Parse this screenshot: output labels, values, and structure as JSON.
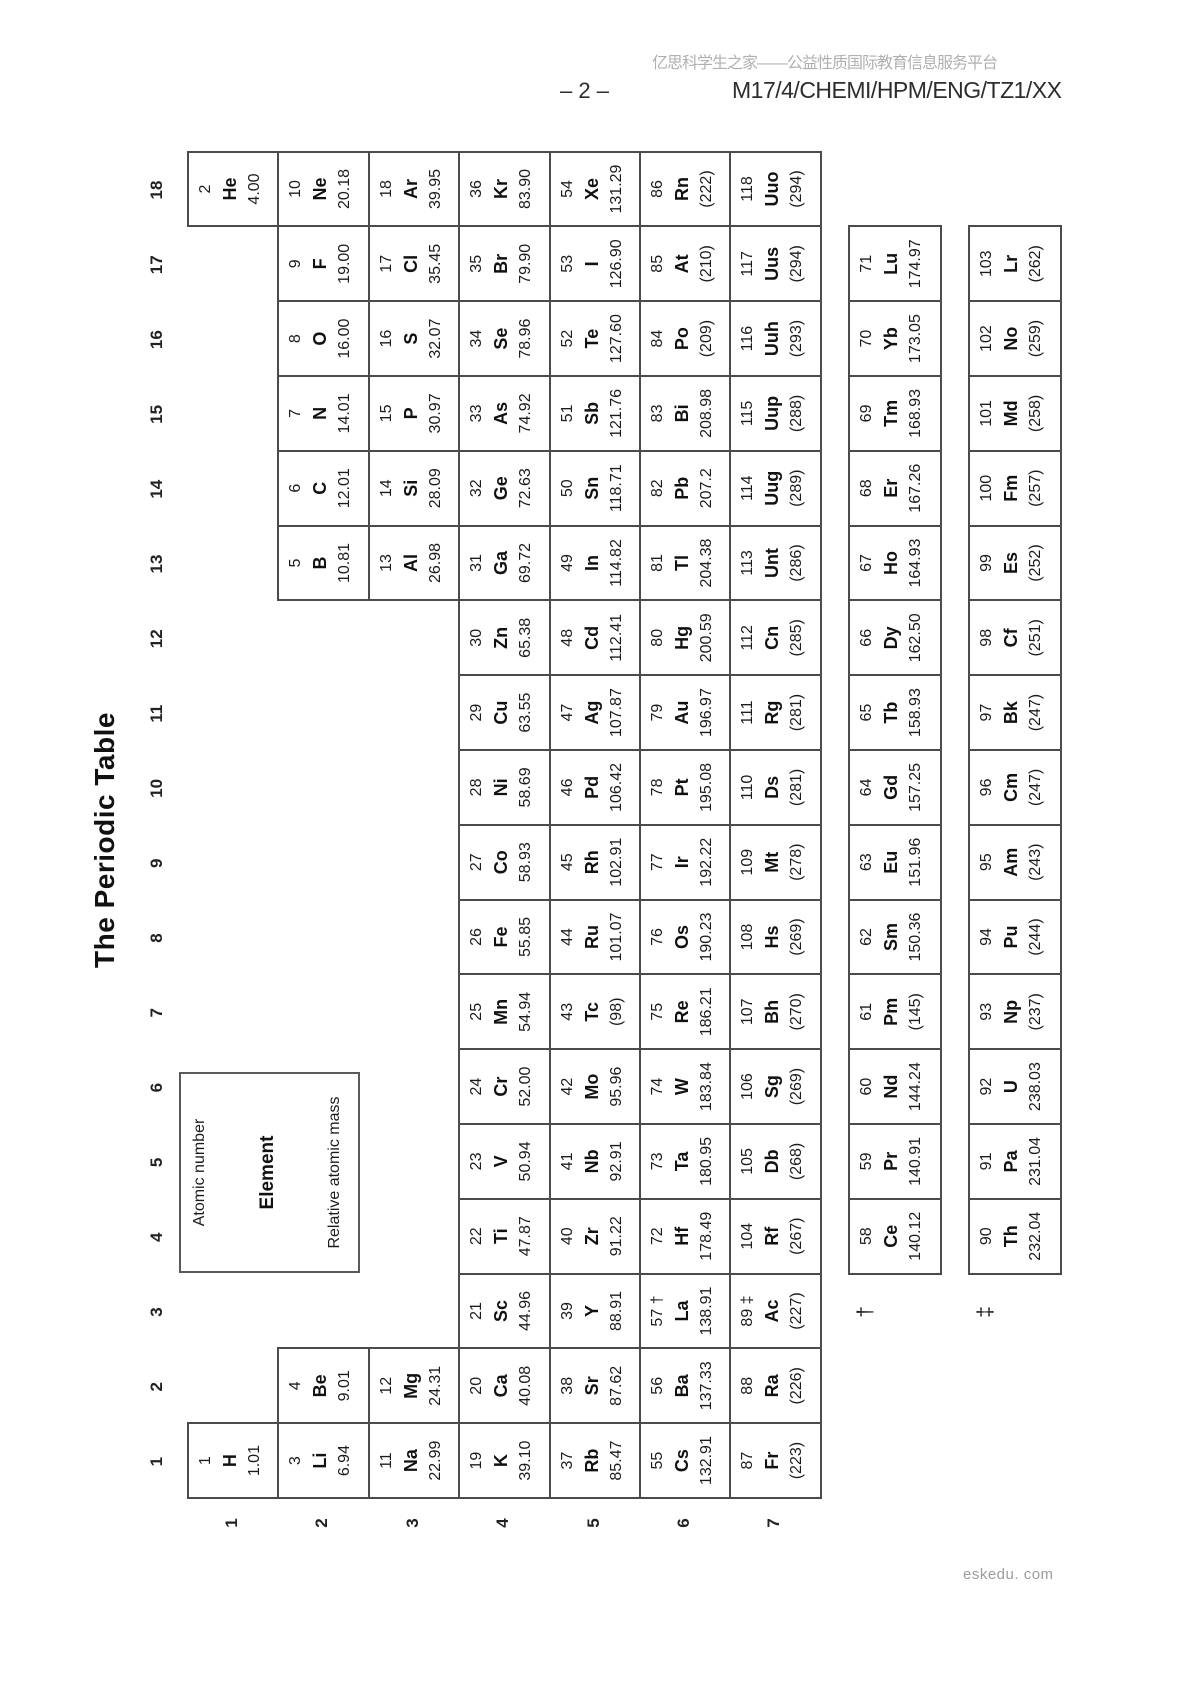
{
  "header": {
    "site_banner": "亿思科学生之家——公益性质国际教育信息服务平台",
    "page_number": "– 2 –",
    "paper_code": "M17/4/CHEMI/HPM/ENG/TZ1/XX"
  },
  "footer": {
    "watermark": "eskedu. com"
  },
  "table": {
    "title": "The Periodic Table",
    "legend": {
      "atomic_number_label": "Atomic number",
      "element_label": "Element",
      "mass_label": "Relative atomic mass"
    },
    "group_labels": [
      "1",
      "2",
      "3",
      "4",
      "5",
      "6",
      "7",
      "8",
      "9",
      "10",
      "11",
      "12",
      "13",
      "14",
      "15",
      "16",
      "17",
      "18"
    ],
    "period_labels": [
      "1",
      "2",
      "3",
      "4",
      "5",
      "6",
      "7"
    ],
    "lanthanide_marker": "†",
    "actinide_marker": "‡",
    "elements": [
      {
        "num": "1",
        "sym": "H",
        "mass": "1.01",
        "g": 1,
        "p": 1
      },
      {
        "num": "2",
        "sym": "He",
        "mass": "4.00",
        "g": 18,
        "p": 1
      },
      {
        "num": "3",
        "sym": "Li",
        "mass": "6.94",
        "g": 1,
        "p": 2
      },
      {
        "num": "4",
        "sym": "Be",
        "mass": "9.01",
        "g": 2,
        "p": 2
      },
      {
        "num": "5",
        "sym": "B",
        "mass": "10.81",
        "g": 13,
        "p": 2
      },
      {
        "num": "6",
        "sym": "C",
        "mass": "12.01",
        "g": 14,
        "p": 2
      },
      {
        "num": "7",
        "sym": "N",
        "mass": "14.01",
        "g": 15,
        "p": 2
      },
      {
        "num": "8",
        "sym": "O",
        "mass": "16.00",
        "g": 16,
        "p": 2
      },
      {
        "num": "9",
        "sym": "F",
        "mass": "19.00",
        "g": 17,
        "p": 2
      },
      {
        "num": "10",
        "sym": "Ne",
        "mass": "20.18",
        "g": 18,
        "p": 2
      },
      {
        "num": "11",
        "sym": "Na",
        "mass": "22.99",
        "g": 1,
        "p": 3
      },
      {
        "num": "12",
        "sym": "Mg",
        "mass": "24.31",
        "g": 2,
        "p": 3
      },
      {
        "num": "13",
        "sym": "Al",
        "mass": "26.98",
        "g": 13,
        "p": 3
      },
      {
        "num": "14",
        "sym": "Si",
        "mass": "28.09",
        "g": 14,
        "p": 3
      },
      {
        "num": "15",
        "sym": "P",
        "mass": "30.97",
        "g": 15,
        "p": 3
      },
      {
        "num": "16",
        "sym": "S",
        "mass": "32.07",
        "g": 16,
        "p": 3
      },
      {
        "num": "17",
        "sym": "Cl",
        "mass": "35.45",
        "g": 17,
        "p": 3
      },
      {
        "num": "18",
        "sym": "Ar",
        "mass": "39.95",
        "g": 18,
        "p": 3
      },
      {
        "num": "19",
        "sym": "K",
        "mass": "39.10",
        "g": 1,
        "p": 4
      },
      {
        "num": "20",
        "sym": "Ca",
        "mass": "40.08",
        "g": 2,
        "p": 4
      },
      {
        "num": "21",
        "sym": "Sc",
        "mass": "44.96",
        "g": 3,
        "p": 4
      },
      {
        "num": "22",
        "sym": "Ti",
        "mass": "47.87",
        "g": 4,
        "p": 4
      },
      {
        "num": "23",
        "sym": "V",
        "mass": "50.94",
        "g": 5,
        "p": 4
      },
      {
        "num": "24",
        "sym": "Cr",
        "mass": "52.00",
        "g": 6,
        "p": 4
      },
      {
        "num": "25",
        "sym": "Mn",
        "mass": "54.94",
        "g": 7,
        "p": 4
      },
      {
        "num": "26",
        "sym": "Fe",
        "mass": "55.85",
        "g": 8,
        "p": 4
      },
      {
        "num": "27",
        "sym": "Co",
        "mass": "58.93",
        "g": 9,
        "p": 4
      },
      {
        "num": "28",
        "sym": "Ni",
        "mass": "58.69",
        "g": 10,
        "p": 4
      },
      {
        "num": "29",
        "sym": "Cu",
        "mass": "63.55",
        "g": 11,
        "p": 4
      },
      {
        "num": "30",
        "sym": "Zn",
        "mass": "65.38",
        "g": 12,
        "p": 4
      },
      {
        "num": "31",
        "sym": "Ga",
        "mass": "69.72",
        "g": 13,
        "p": 4
      },
      {
        "num": "32",
        "sym": "Ge",
        "mass": "72.63",
        "g": 14,
        "p": 4
      },
      {
        "num": "33",
        "sym": "As",
        "mass": "74.92",
        "g": 15,
        "p": 4
      },
      {
        "num": "34",
        "sym": "Se",
        "mass": "78.96",
        "g": 16,
        "p": 4
      },
      {
        "num": "35",
        "sym": "Br",
        "mass": "79.90",
        "g": 17,
        "p": 4
      },
      {
        "num": "36",
        "sym": "Kr",
        "mass": "83.90",
        "g": 18,
        "p": 4
      },
      {
        "num": "37",
        "sym": "Rb",
        "mass": "85.47",
        "g": 1,
        "p": 5
      },
      {
        "num": "38",
        "sym": "Sr",
        "mass": "87.62",
        "g": 2,
        "p": 5
      },
      {
        "num": "39",
        "sym": "Y",
        "mass": "88.91",
        "g": 3,
        "p": 5
      },
      {
        "num": "40",
        "sym": "Zr",
        "mass": "91.22",
        "g": 4,
        "p": 5
      },
      {
        "num": "41",
        "sym": "Nb",
        "mass": "92.91",
        "g": 5,
        "p": 5
      },
      {
        "num": "42",
        "sym": "Mo",
        "mass": "95.96",
        "g": 6,
        "p": 5
      },
      {
        "num": "43",
        "sym": "Tc",
        "mass": "(98)",
        "g": 7,
        "p": 5
      },
      {
        "num": "44",
        "sym": "Ru",
        "mass": "101.07",
        "g": 8,
        "p": 5
      },
      {
        "num": "45",
        "sym": "Rh",
        "mass": "102.91",
        "g": 9,
        "p": 5
      },
      {
        "num": "46",
        "sym": "Pd",
        "mass": "106.42",
        "g": 10,
        "p": 5
      },
      {
        "num": "47",
        "sym": "Ag",
        "mass": "107.87",
        "g": 11,
        "p": 5
      },
      {
        "num": "48",
        "sym": "Cd",
        "mass": "112.41",
        "g": 12,
        "p": 5
      },
      {
        "num": "49",
        "sym": "In",
        "mass": "114.82",
        "g": 13,
        "p": 5
      },
      {
        "num": "50",
        "sym": "Sn",
        "mass": "118.71",
        "g": 14,
        "p": 5
      },
      {
        "num": "51",
        "sym": "Sb",
        "mass": "121.76",
        "g": 15,
        "p": 5
      },
      {
        "num": "52",
        "sym": "Te",
        "mass": "127.60",
        "g": 16,
        "p": 5
      },
      {
        "num": "53",
        "sym": "I",
        "mass": "126.90",
        "g": 17,
        "p": 5
      },
      {
        "num": "54",
        "sym": "Xe",
        "mass": "131.29",
        "g": 18,
        "p": 5
      },
      {
        "num": "55",
        "sym": "Cs",
        "mass": "132.91",
        "g": 1,
        "p": 6
      },
      {
        "num": "56",
        "sym": "Ba",
        "mass": "137.33",
        "g": 2,
        "p": 6
      },
      {
        "num": "57 †",
        "sym": "La",
        "mass": "138.91",
        "g": 3,
        "p": 6
      },
      {
        "num": "72",
        "sym": "Hf",
        "mass": "178.49",
        "g": 4,
        "p": 6
      },
      {
        "num": "73",
        "sym": "Ta",
        "mass": "180.95",
        "g": 5,
        "p": 6
      },
      {
        "num": "74",
        "sym": "W",
        "mass": "183.84",
        "g": 6,
        "p": 6
      },
      {
        "num": "75",
        "sym": "Re",
        "mass": "186.21",
        "g": 7,
        "p": 6
      },
      {
        "num": "76",
        "sym": "Os",
        "mass": "190.23",
        "g": 8,
        "p": 6
      },
      {
        "num": "77",
        "sym": "Ir",
        "mass": "192.22",
        "g": 9,
        "p": 6
      },
      {
        "num": "78",
        "sym": "Pt",
        "mass": "195.08",
        "g": 10,
        "p": 6
      },
      {
        "num": "79",
        "sym": "Au",
        "mass": "196.97",
        "g": 11,
        "p": 6
      },
      {
        "num": "80",
        "sym": "Hg",
        "mass": "200.59",
        "g": 12,
        "p": 6
      },
      {
        "num": "81",
        "sym": "Tl",
        "mass": "204.38",
        "g": 13,
        "p": 6
      },
      {
        "num": "82",
        "sym": "Pb",
        "mass": "207.2",
        "g": 14,
        "p": 6
      },
      {
        "num": "83",
        "sym": "Bi",
        "mass": "208.98",
        "g": 15,
        "p": 6
      },
      {
        "num": "84",
        "sym": "Po",
        "mass": "(209)",
        "g": 16,
        "p": 6
      },
      {
        "num": "85",
        "sym": "At",
        "mass": "(210)",
        "g": 17,
        "p": 6
      },
      {
        "num": "86",
        "sym": "Rn",
        "mass": "(222)",
        "g": 18,
        "p": 6
      },
      {
        "num": "87",
        "sym": "Fr",
        "mass": "(223)",
        "g": 1,
        "p": 7
      },
      {
        "num": "88",
        "sym": "Ra",
        "mass": "(226)",
        "g": 2,
        "p": 7
      },
      {
        "num": "89 ‡",
        "sym": "Ac",
        "mass": "(227)",
        "g": 3,
        "p": 7
      },
      {
        "num": "104",
        "sym": "Rf",
        "mass": "(267)",
        "g": 4,
        "p": 7
      },
      {
        "num": "105",
        "sym": "Db",
        "mass": "(268)",
        "g": 5,
        "p": 7
      },
      {
        "num": "106",
        "sym": "Sg",
        "mass": "(269)",
        "g": 6,
        "p": 7
      },
      {
        "num": "107",
        "sym": "Bh",
        "mass": "(270)",
        "g": 7,
        "p": 7
      },
      {
        "num": "108",
        "sym": "Hs",
        "mass": "(269)",
        "g": 8,
        "p": 7
      },
      {
        "num": "109",
        "sym": "Mt",
        "mass": "(278)",
        "g": 9,
        "p": 7
      },
      {
        "num": "110",
        "sym": "Ds",
        "mass": "(281)",
        "g": 10,
        "p": 7
      },
      {
        "num": "111",
        "sym": "Rg",
        "mass": "(281)",
        "g": 11,
        "p": 7
      },
      {
        "num": "112",
        "sym": "Cn",
        "mass": "(285)",
        "g": 12,
        "p": 7
      },
      {
        "num": "113",
        "sym": "Unt",
        "mass": "(286)",
        "g": 13,
        "p": 7
      },
      {
        "num": "114",
        "sym": "Uug",
        "mass": "(289)",
        "g": 14,
        "p": 7
      },
      {
        "num": "115",
        "sym": "Uup",
        "mass": "(288)",
        "g": 15,
        "p": 7
      },
      {
        "num": "116",
        "sym": "Uuh",
        "mass": "(293)",
        "g": 16,
        "p": 7
      },
      {
        "num": "117",
        "sym": "Uus",
        "mass": "(294)",
        "g": 17,
        "p": 7
      },
      {
        "num": "118",
        "sym": "Uuo",
        "mass": "(294)",
        "g": 18,
        "p": 7
      }
    ],
    "lanthanides": [
      {
        "num": "58",
        "sym": "Ce",
        "mass": "140.12"
      },
      {
        "num": "59",
        "sym": "Pr",
        "mass": "140.91"
      },
      {
        "num": "60",
        "sym": "Nd",
        "mass": "144.24"
      },
      {
        "num": "61",
        "sym": "Pm",
        "mass": "(145)"
      },
      {
        "num": "62",
        "sym": "Sm",
        "mass": "150.36"
      },
      {
        "num": "63",
        "sym": "Eu",
        "mass": "151.96"
      },
      {
        "num": "64",
        "sym": "Gd",
        "mass": "157.25"
      },
      {
        "num": "65",
        "sym": "Tb",
        "mass": "158.93"
      },
      {
        "num": "66",
        "sym": "Dy",
        "mass": "162.50"
      },
      {
        "num": "67",
        "sym": "Ho",
        "mass": "164.93"
      },
      {
        "num": "68",
        "sym": "Er",
        "mass": "167.26"
      },
      {
        "num": "69",
        "sym": "Tm",
        "mass": "168.93"
      },
      {
        "num": "70",
        "sym": "Yb",
        "mass": "173.05"
      },
      {
        "num": "71",
        "sym": "Lu",
        "mass": "174.97"
      }
    ],
    "actinides": [
      {
        "num": "90",
        "sym": "Th",
        "mass": "232.04"
      },
      {
        "num": "91",
        "sym": "Pa",
        "mass": "231.04"
      },
      {
        "num": "92",
        "sym": "U",
        "mass": "238.03"
      },
      {
        "num": "93",
        "sym": "Np",
        "mass": "(237)"
      },
      {
        "num": "94",
        "sym": "Pu",
        "mass": "(244)"
      },
      {
        "num": "95",
        "sym": "Am",
        "mass": "(243)"
      },
      {
        "num": "96",
        "sym": "Cm",
        "mass": "(247)"
      },
      {
        "num": "97",
        "sym": "Bk",
        "mass": "(247)"
      },
      {
        "num": "98",
        "sym": "Cf",
        "mass": "(251)"
      },
      {
        "num": "99",
        "sym": "Es",
        "mass": "(252)"
      },
      {
        "num": "100",
        "sym": "Fm",
        "mass": "(257)"
      },
      {
        "num": "101",
        "sym": "Md",
        "mass": "(258)"
      },
      {
        "num": "102",
        "sym": "No",
        "mass": "(259)"
      },
      {
        "num": "103",
        "sym": "Lr",
        "mass": "(262)"
      }
    ]
  }
}
